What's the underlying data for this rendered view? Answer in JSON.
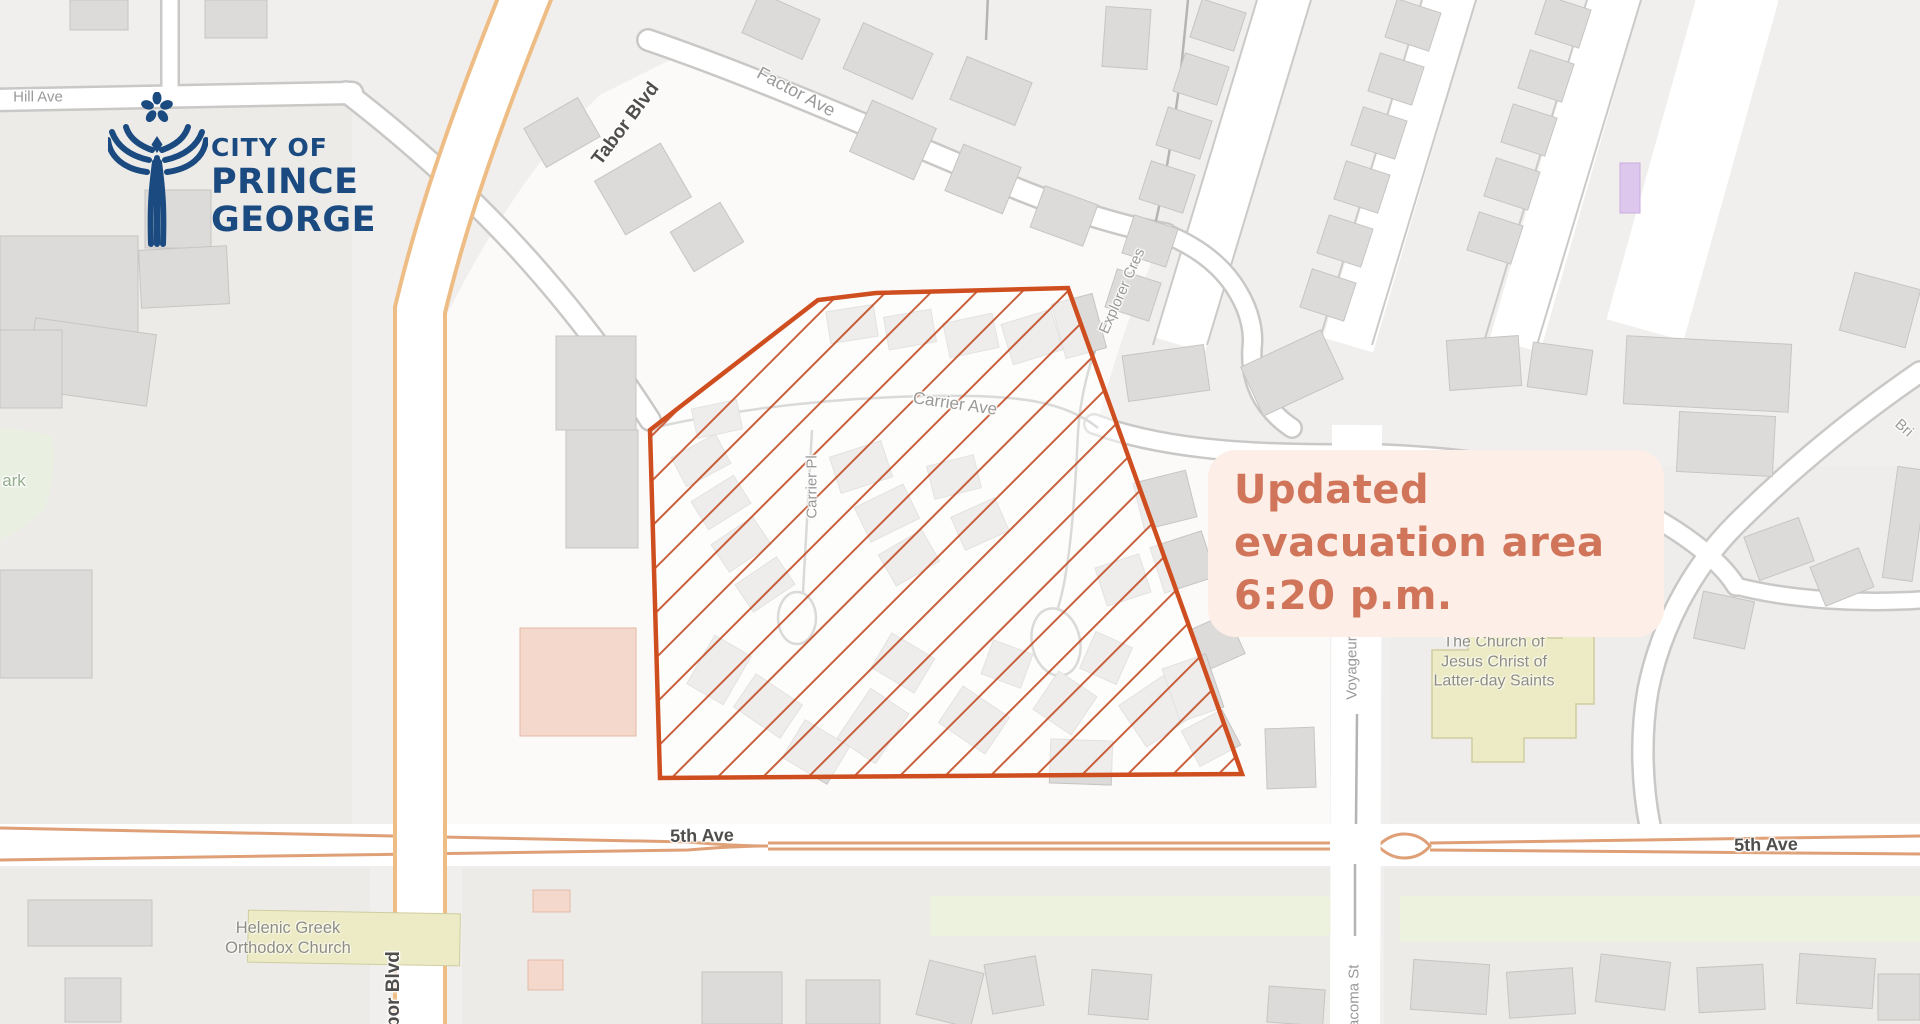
{
  "logo": {
    "color": "#1a4a80",
    "line1": "CITY OF",
    "line2": "PRINCE",
    "line3": "GEORGE"
  },
  "overlay": {
    "bg": "#fdeee7",
    "text_color": "#d0755a",
    "lines": [
      "Updated",
      "evacuation area",
      "6:20 p.m."
    ]
  },
  "evacuation_zone": {
    "stroke": "#cf4e1f",
    "hatch": "#c3502a",
    "fill_wash": "rgba(255,255,255,0.5)",
    "points": "650,430 818,300 876,293 1068,288 1242,774 660,778"
  },
  "street_labels": [
    {
      "text": "Hill Ave"
    },
    {
      "text": "Tabor Blvd"
    },
    {
      "text": "Factor Ave"
    },
    {
      "text": "Carrier Ave"
    },
    {
      "text": "Carrier Pl"
    },
    {
      "text": "Explorer Cres"
    },
    {
      "text": "5th Ave"
    },
    {
      "text": "5th Ave"
    },
    {
      "text": "Voyageur"
    },
    {
      "text": "Tacoma St"
    },
    {
      "text": "Tabor Blvd"
    },
    {
      "text": "ark"
    },
    {
      "text": "Bri"
    }
  ],
  "poi_labels": [
    {
      "lines": [
        "The Church of",
        "Jesus Christ of",
        "Latter-day Saints"
      ]
    },
    {
      "lines": [
        "Helenic Greek",
        "Orthodox Church"
      ]
    }
  ],
  "map_colors": {
    "background": "#f1efed",
    "block": "#ecebe8",
    "road_fill": "#ffffff",
    "minor_casing": "#c9c8c6",
    "major_casing_tabor": "#eebd85",
    "major_casing_5th": "#dfa077",
    "building_fill": "#dcdbd9",
    "building_stroke": "#c6c5c3",
    "building_pink": "#f3d8cb",
    "building_khaki": "#ecebc5",
    "building_lavender": "#ddc7ec",
    "green_area": "#ecf2de"
  }
}
